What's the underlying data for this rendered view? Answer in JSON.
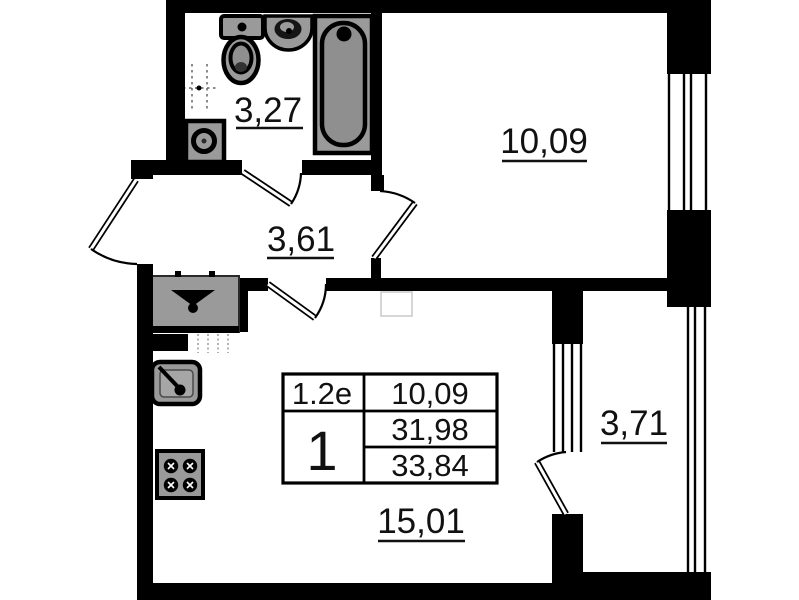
{
  "plan_info": {
    "apartment_type": "1.2е",
    "room_count": "1",
    "living_area": "10,09",
    "area_without_balcony": "31,98",
    "total_area": "33,84"
  },
  "room_labels": {
    "bathroom": "3,27",
    "room": "10,09",
    "hallway": "3,61",
    "kitchen_living": "15,01",
    "balcony": "3,71"
  },
  "colors": {
    "walls": "#000000",
    "fixtures": "#9a9a9a",
    "fixture_inner": "#8f8f8f",
    "background": "#ffffff"
  }
}
